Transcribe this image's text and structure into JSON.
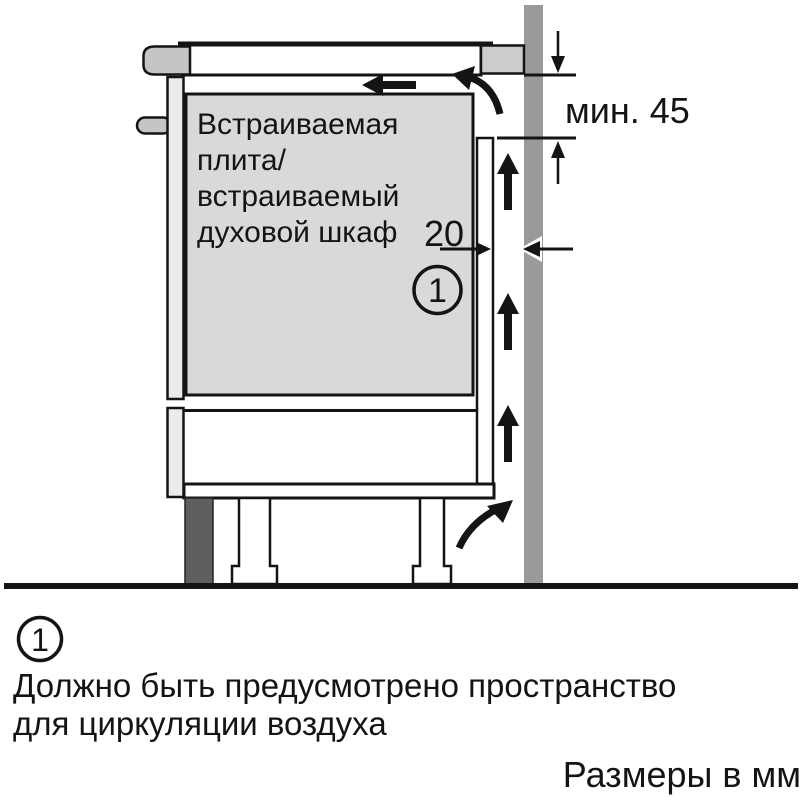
{
  "diagram": {
    "appliance_label_lines": [
      "Встраиваемая",
      "плита/",
      "встраиваемый",
      "духовой шкаф"
    ],
    "min_gap_label": "мин. 45",
    "gap_label": "20",
    "callout_marker": "1"
  },
  "footnote": {
    "marker": "1",
    "line1": "Должно быть предусмотрено пространство",
    "line2": "для циркуляции воздуха"
  },
  "units_label": "Размеры в мм",
  "colors": {
    "background": "#ffffff",
    "line": "#141414",
    "wall": "#9a9a9a",
    "appliance_fill": "#d9d9d9",
    "panel_fill": "#ebebeb",
    "handle_fill": "#c5c5c5",
    "worktop_end_fill": "#cccccc",
    "plinth_fill": "#5f5f5f"
  }
}
